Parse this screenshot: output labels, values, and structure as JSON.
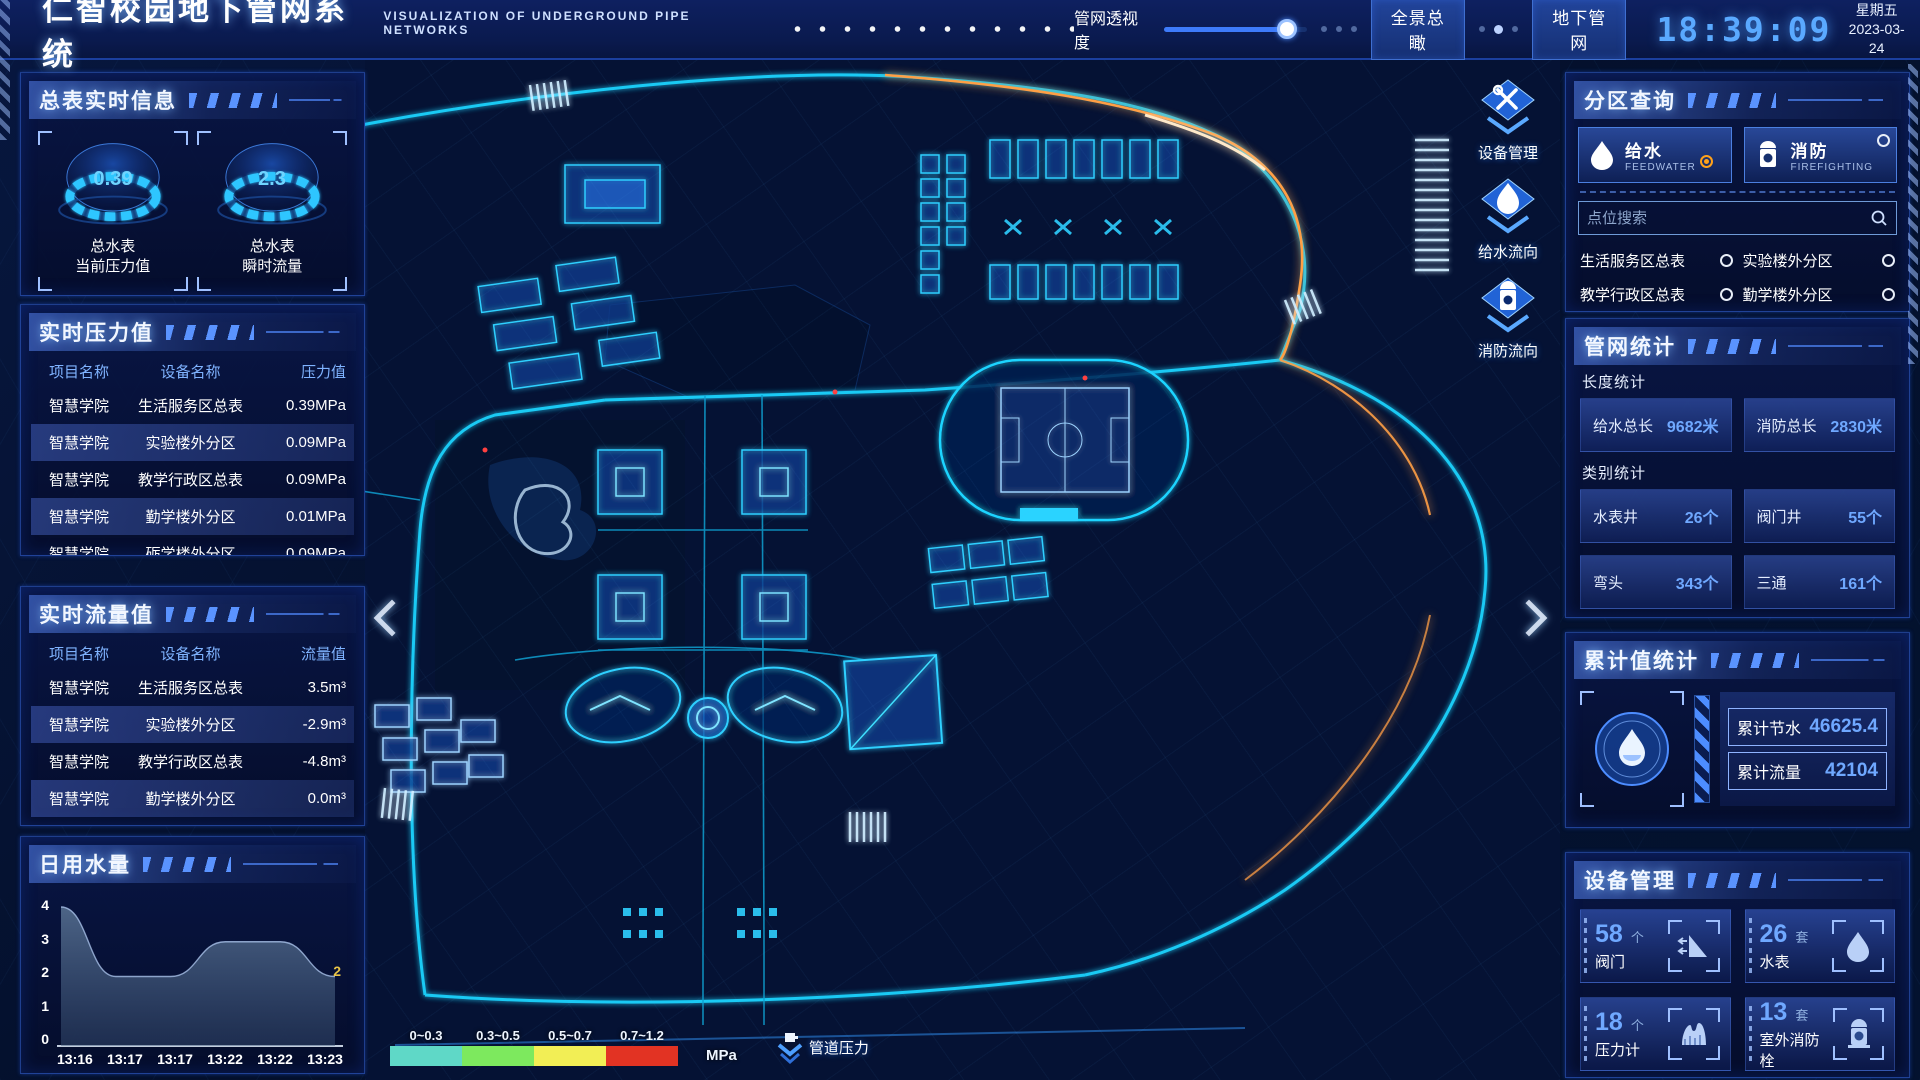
{
  "header": {
    "title": "仁智校园地下管网系统",
    "subtitle": "VISUALIZATION OF UNDERGROUND PIPE NETWORKS",
    "opacity_label": "管网透视度",
    "btn_overview": "全景总瞰",
    "btn_underground": "地下管网",
    "time": "18:39:09",
    "weekday": "星期五",
    "date": "2023-03-24"
  },
  "meter_info": {
    "title": "总表实时信息",
    "gauges": [
      {
        "value": "0.39",
        "label1": "总水表",
        "label2": "当前压力值"
      },
      {
        "value": "2.3",
        "label1": "总水表",
        "label2": "瞬时流量"
      }
    ]
  },
  "pressure": {
    "title": "实时压力值",
    "headers": [
      "项目名称",
      "设备名称",
      "压力值"
    ],
    "rows": [
      {
        "project": "智慧学院",
        "device": "生活服务区总表",
        "value": "0.39MPa"
      },
      {
        "project": "智慧学院",
        "device": "实验楼外分区",
        "value": "0.09MPa"
      },
      {
        "project": "智慧学院",
        "device": "教学行政区总表",
        "value": "0.09MPa"
      },
      {
        "project": "智慧学院",
        "device": "勤学楼外分区",
        "value": "0.01MPa"
      },
      {
        "project": "智慧学院",
        "device": "砺学楼外分区",
        "value": "0.09MPa"
      }
    ]
  },
  "flow": {
    "title": "实时流量值",
    "headers": [
      "项目名称",
      "设备名称",
      "流量值"
    ],
    "rows": [
      {
        "project": "智慧学院",
        "device": "生活服务区总表",
        "value": "3.5m³"
      },
      {
        "project": "智慧学院",
        "device": "实验楼外分区",
        "value": "-2.9m³"
      },
      {
        "project": "智慧学院",
        "device": "教学行政区总表",
        "value": "-4.8m³"
      },
      {
        "project": "智慧学院",
        "device": "勤学楼外分区",
        "value": "0.0m³"
      },
      {
        "project": "智慧学院",
        "device": "砺学楼外分区",
        "value": "2.3m³"
      }
    ]
  },
  "chart_data": {
    "type": "area",
    "title": "日用水量",
    "x": [
      "13:16",
      "13:17",
      "13:17",
      "13:22",
      "13:22",
      "13:23"
    ],
    "values": [
      4,
      2,
      2,
      3,
      3,
      2
    ],
    "yticks": [
      0,
      1,
      2,
      3,
      4
    ],
    "ylim": [
      0,
      4
    ],
    "end_label": "2",
    "grid": false,
    "legend_position": "none"
  },
  "map": {
    "overlay_buttons": [
      {
        "label": "设备管理",
        "icon": "wrench-icon"
      },
      {
        "label": "给水流向",
        "icon": "waterdrop-icon"
      },
      {
        "label": "消防流向",
        "icon": "hydrant-icon"
      }
    ],
    "legend": {
      "ranges": [
        {
          "label": "0~0.3",
          "color": "#5fd8c7"
        },
        {
          "label": "0.3~0.5",
          "color": "#7de95e"
        },
        {
          "label": "0.5~0.7",
          "color": "#f2ee55"
        },
        {
          "label": "0.7~1.2",
          "color": "#e23323"
        }
      ],
      "unit": "MPa",
      "pipe_pressure_label": "管道压力"
    }
  },
  "zone_query": {
    "title": "分区查询",
    "tabs": [
      {
        "label": "给水",
        "sub": "FEEDWATER",
        "selected": true
      },
      {
        "label": "消防",
        "sub": "FIREFIGHTING",
        "selected": false
      }
    ],
    "search_placeholder": "点位搜索",
    "items": [
      "生活服务区总表",
      "实验楼外分区",
      "教学行政区总表",
      "勤学楼外分区",
      "砺学楼外分区",
      "宿舍区泵房"
    ]
  },
  "pipe_stats": {
    "title": "管网统计",
    "length_label": "长度统计",
    "length_stats": [
      {
        "label": "给水总长",
        "value": "9682米"
      },
      {
        "label": "消防总长",
        "value": "2830米"
      }
    ],
    "category_label": "类别统计",
    "category_stats": [
      {
        "label": "水表井",
        "value": "26个"
      },
      {
        "label": "阀门井",
        "value": "55个"
      },
      {
        "label": "弯头",
        "value": "343个"
      },
      {
        "label": "三通",
        "value": "161个"
      }
    ]
  },
  "cumulative": {
    "title": "累计值统计",
    "stats": [
      {
        "label": "累计节水",
        "value": "46625.4"
      },
      {
        "label": "累计流量",
        "value": "42104"
      }
    ]
  },
  "devices": {
    "title": "设备管理",
    "cards": [
      {
        "count": "58",
        "unit": "个",
        "label": "阀门",
        "icon": "valve-icon"
      },
      {
        "count": "26",
        "unit": "套",
        "label": "水表",
        "icon": "water-meter-icon"
      },
      {
        "count": "18",
        "unit": "个",
        "label": "压力计",
        "icon": "pressure-gauge-icon"
      },
      {
        "count": "13",
        "unit": "套",
        "label": "室外消防栓",
        "icon": "outdoor-hydrant-icon"
      }
    ]
  }
}
